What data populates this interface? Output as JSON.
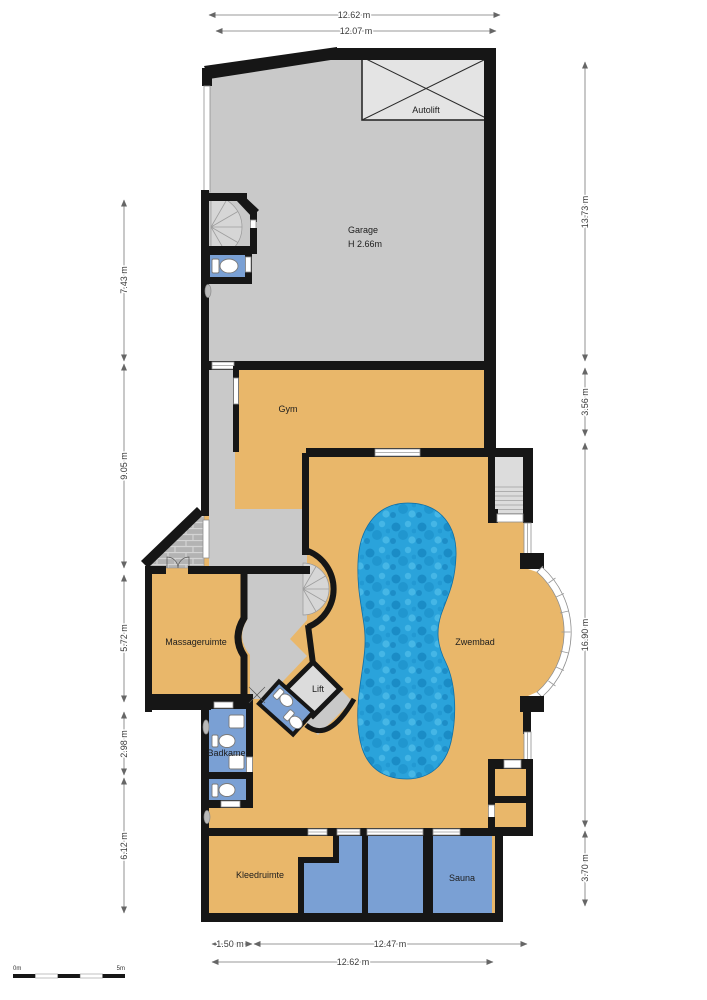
{
  "plan_title": "Basement floor plan with pool",
  "rooms": {
    "garage": {
      "label": "Garage",
      "height": "H 2.66m"
    },
    "autolift": {
      "label": "Autolift"
    },
    "gym": {
      "label": "Gym"
    },
    "massageruimte": {
      "label": "Massageruimte"
    },
    "lift": {
      "label": "Lift"
    },
    "badkamer": {
      "label": "Badkamer"
    },
    "zwembad": {
      "label": "Zwembad"
    },
    "kleedruimte": {
      "label": "Kleedruimte"
    },
    "sauna": {
      "label": "Sauna"
    }
  },
  "dimensions": {
    "top": [
      {
        "label": "12.62 m"
      },
      {
        "label": "12.07 m"
      }
    ],
    "left": [
      {
        "label": "7.43 m"
      },
      {
        "label": "9.05 m"
      },
      {
        "label": "5.72 m"
      },
      {
        "label": "2.98 m"
      },
      {
        "label": "6.12 m"
      }
    ],
    "right": [
      {
        "label": "13.73 m"
      },
      {
        "label": "3.56 m"
      },
      {
        "label": "16.90 m"
      },
      {
        "label": "3.70 m"
      }
    ],
    "bottom": [
      {
        "label": "1.50 m"
      },
      {
        "label": "12.47 m"
      },
      {
        "label": "12.62 m"
      }
    ]
  },
  "scale_bar": {
    "start": "0m",
    "end": "5m"
  },
  "colors": {
    "wall": "#161616",
    "floor_warm": "#e9b76a",
    "floor_gray": "#c9c9c9",
    "room_blue": "#7aa0d4",
    "pool_blue": "#2aa3db",
    "light_gray": "#dcdcdc"
  }
}
